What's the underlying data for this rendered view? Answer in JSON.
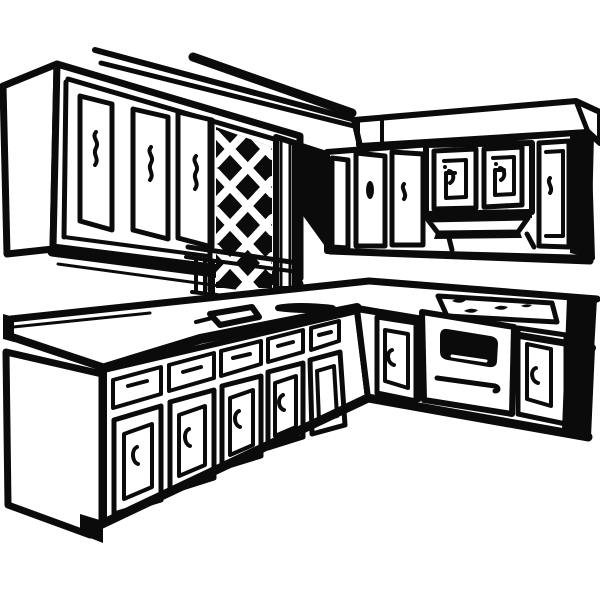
{
  "meta": {
    "title": "Kitchen cabinets line-art illustration",
    "description": "Black-and-white hand-drawn clip art of an L-shaped kitchen: upper wall cabinets with squiggle handles, a diamond lattice panel with a fluted pillar, upper-right cabinets with a vent hood, and an L-shaped base counter with sink basins, a four-burner cooktop, drawers, cabinet doors and an oven with a black window."
  },
  "palette": {
    "ink": "#0b0b0b",
    "paper": "#ffffff"
  },
  "scene": {
    "style": "thick black outlines on white, two-point perspective",
    "components": [
      {
        "id": "ceiling-trim",
        "label": "Ceiling / crown molding lines",
        "lines": 3
      },
      {
        "id": "soffit-right",
        "label": "Right soffit band with end cap and dividers"
      },
      {
        "id": "upper-cabinets-left",
        "label": "Upper-left cabinet run",
        "doors": 3,
        "handle_style": "vertical squiggle"
      },
      {
        "id": "lattice-panel",
        "label": "Diamond lattice panel",
        "pattern": "white diagonal lattice on black"
      },
      {
        "id": "pillar",
        "label": "Fluted pillar beside lattice"
      },
      {
        "id": "upper-cabinets-right",
        "label": "Upper-right cabinet run",
        "doors": 6,
        "end_panel": "black"
      },
      {
        "id": "range-hood",
        "label": "Vent hood under center upper cabinets"
      },
      {
        "id": "countertop",
        "label": "L-shaped countertop with backsplash edge"
      },
      {
        "id": "sink",
        "label": "Double sink basins near inside corner",
        "basins": 2
      },
      {
        "id": "cooktop",
        "label": "Cooktop with burner marks",
        "burners": 5
      },
      {
        "id": "base-cabinets-left",
        "label": "Left base run",
        "drawers": 5,
        "doors": 5
      },
      {
        "id": "oven",
        "label": "Oven with black window and handle bar"
      },
      {
        "id": "base-cabinets-right",
        "label": "Right base run",
        "doors": 2,
        "end_panel": "black"
      }
    ]
  }
}
